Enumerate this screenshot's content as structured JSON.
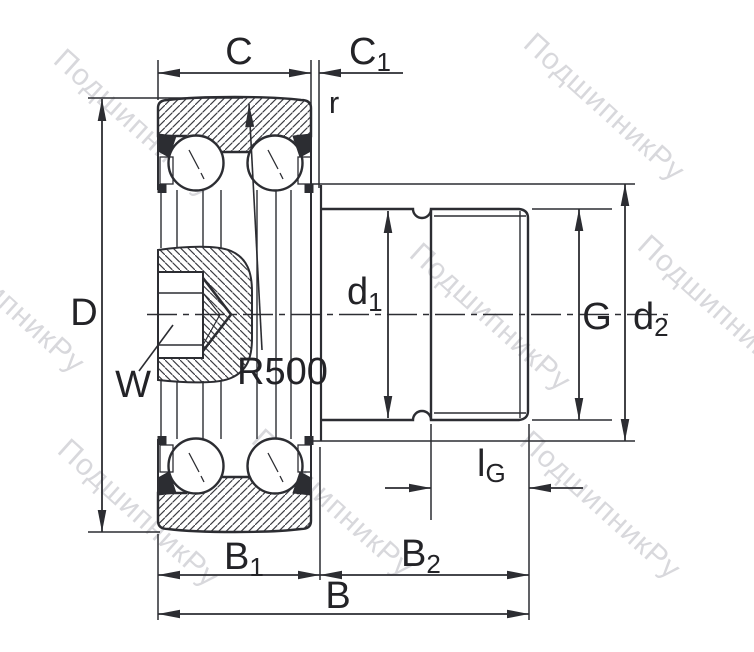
{
  "title": "Bearing cross-section technical drawing",
  "watermark": {
    "text": "ПодшипникРу",
    "color": "#b9bac1"
  },
  "colors": {
    "line": "#2c2d32",
    "text": "#232327",
    "hatch": "#3a3b42",
    "background": "#ffffff"
  },
  "dimensions": {
    "C": {
      "main": "C"
    },
    "C1": {
      "main": "C",
      "sub": "1"
    },
    "r": {
      "main": "r"
    },
    "D": {
      "main": "D"
    },
    "W": {
      "main": "W"
    },
    "R500": {
      "main": "R500"
    },
    "d1": {
      "main": "d",
      "sub": "1"
    },
    "lG": {
      "main": "l",
      "sub": "G"
    },
    "G": {
      "main": "G"
    },
    "d2": {
      "main": "d",
      "sub": "2"
    },
    "B1": {
      "main": "B",
      "sub": "1"
    },
    "B2": {
      "main": "B",
      "sub": "2"
    },
    "B": {
      "main": "B"
    }
  }
}
